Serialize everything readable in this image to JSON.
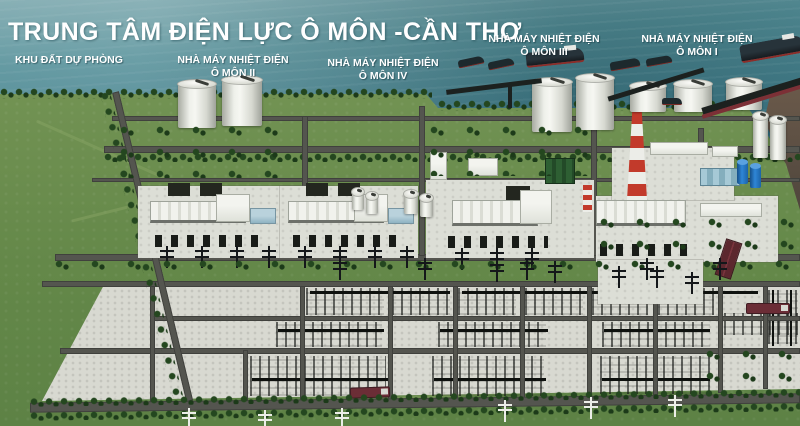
{
  "title": "TRUNG TÂM ĐIỆN LỰC Ô MÔN -CẦN THƠ",
  "labels": {
    "reserve": {
      "text": "KHU ĐẤT DỰ PHÒNG"
    },
    "omon2": {
      "line1": "NHÀ MÁY NHIỆT ĐIỆN",
      "line2": "Ô MÔN II"
    },
    "omon4": {
      "line1": "NHÀ MÁY NHIỆT ĐIỆN",
      "line2": "Ô MÔN IV"
    },
    "omon3": {
      "line1": "NHÀ MÁY NHIỆT ĐIỆN",
      "line2": "Ô MÔN III"
    },
    "omon1": {
      "line1": "NHÀ MÁY NHIỆT ĐIỆN",
      "line2": "Ô MÔN I"
    }
  },
  "colors": {
    "water": "#3d7988",
    "land_green": "#6f9051",
    "gravel": "#d8d9d1",
    "road": "#54554f",
    "chimney_red": "#c23a2b",
    "tank_white": "#f2f3ee",
    "pier_red": "#7c3036",
    "tree_green": "#24471f",
    "label_text": "#ffffff"
  }
}
